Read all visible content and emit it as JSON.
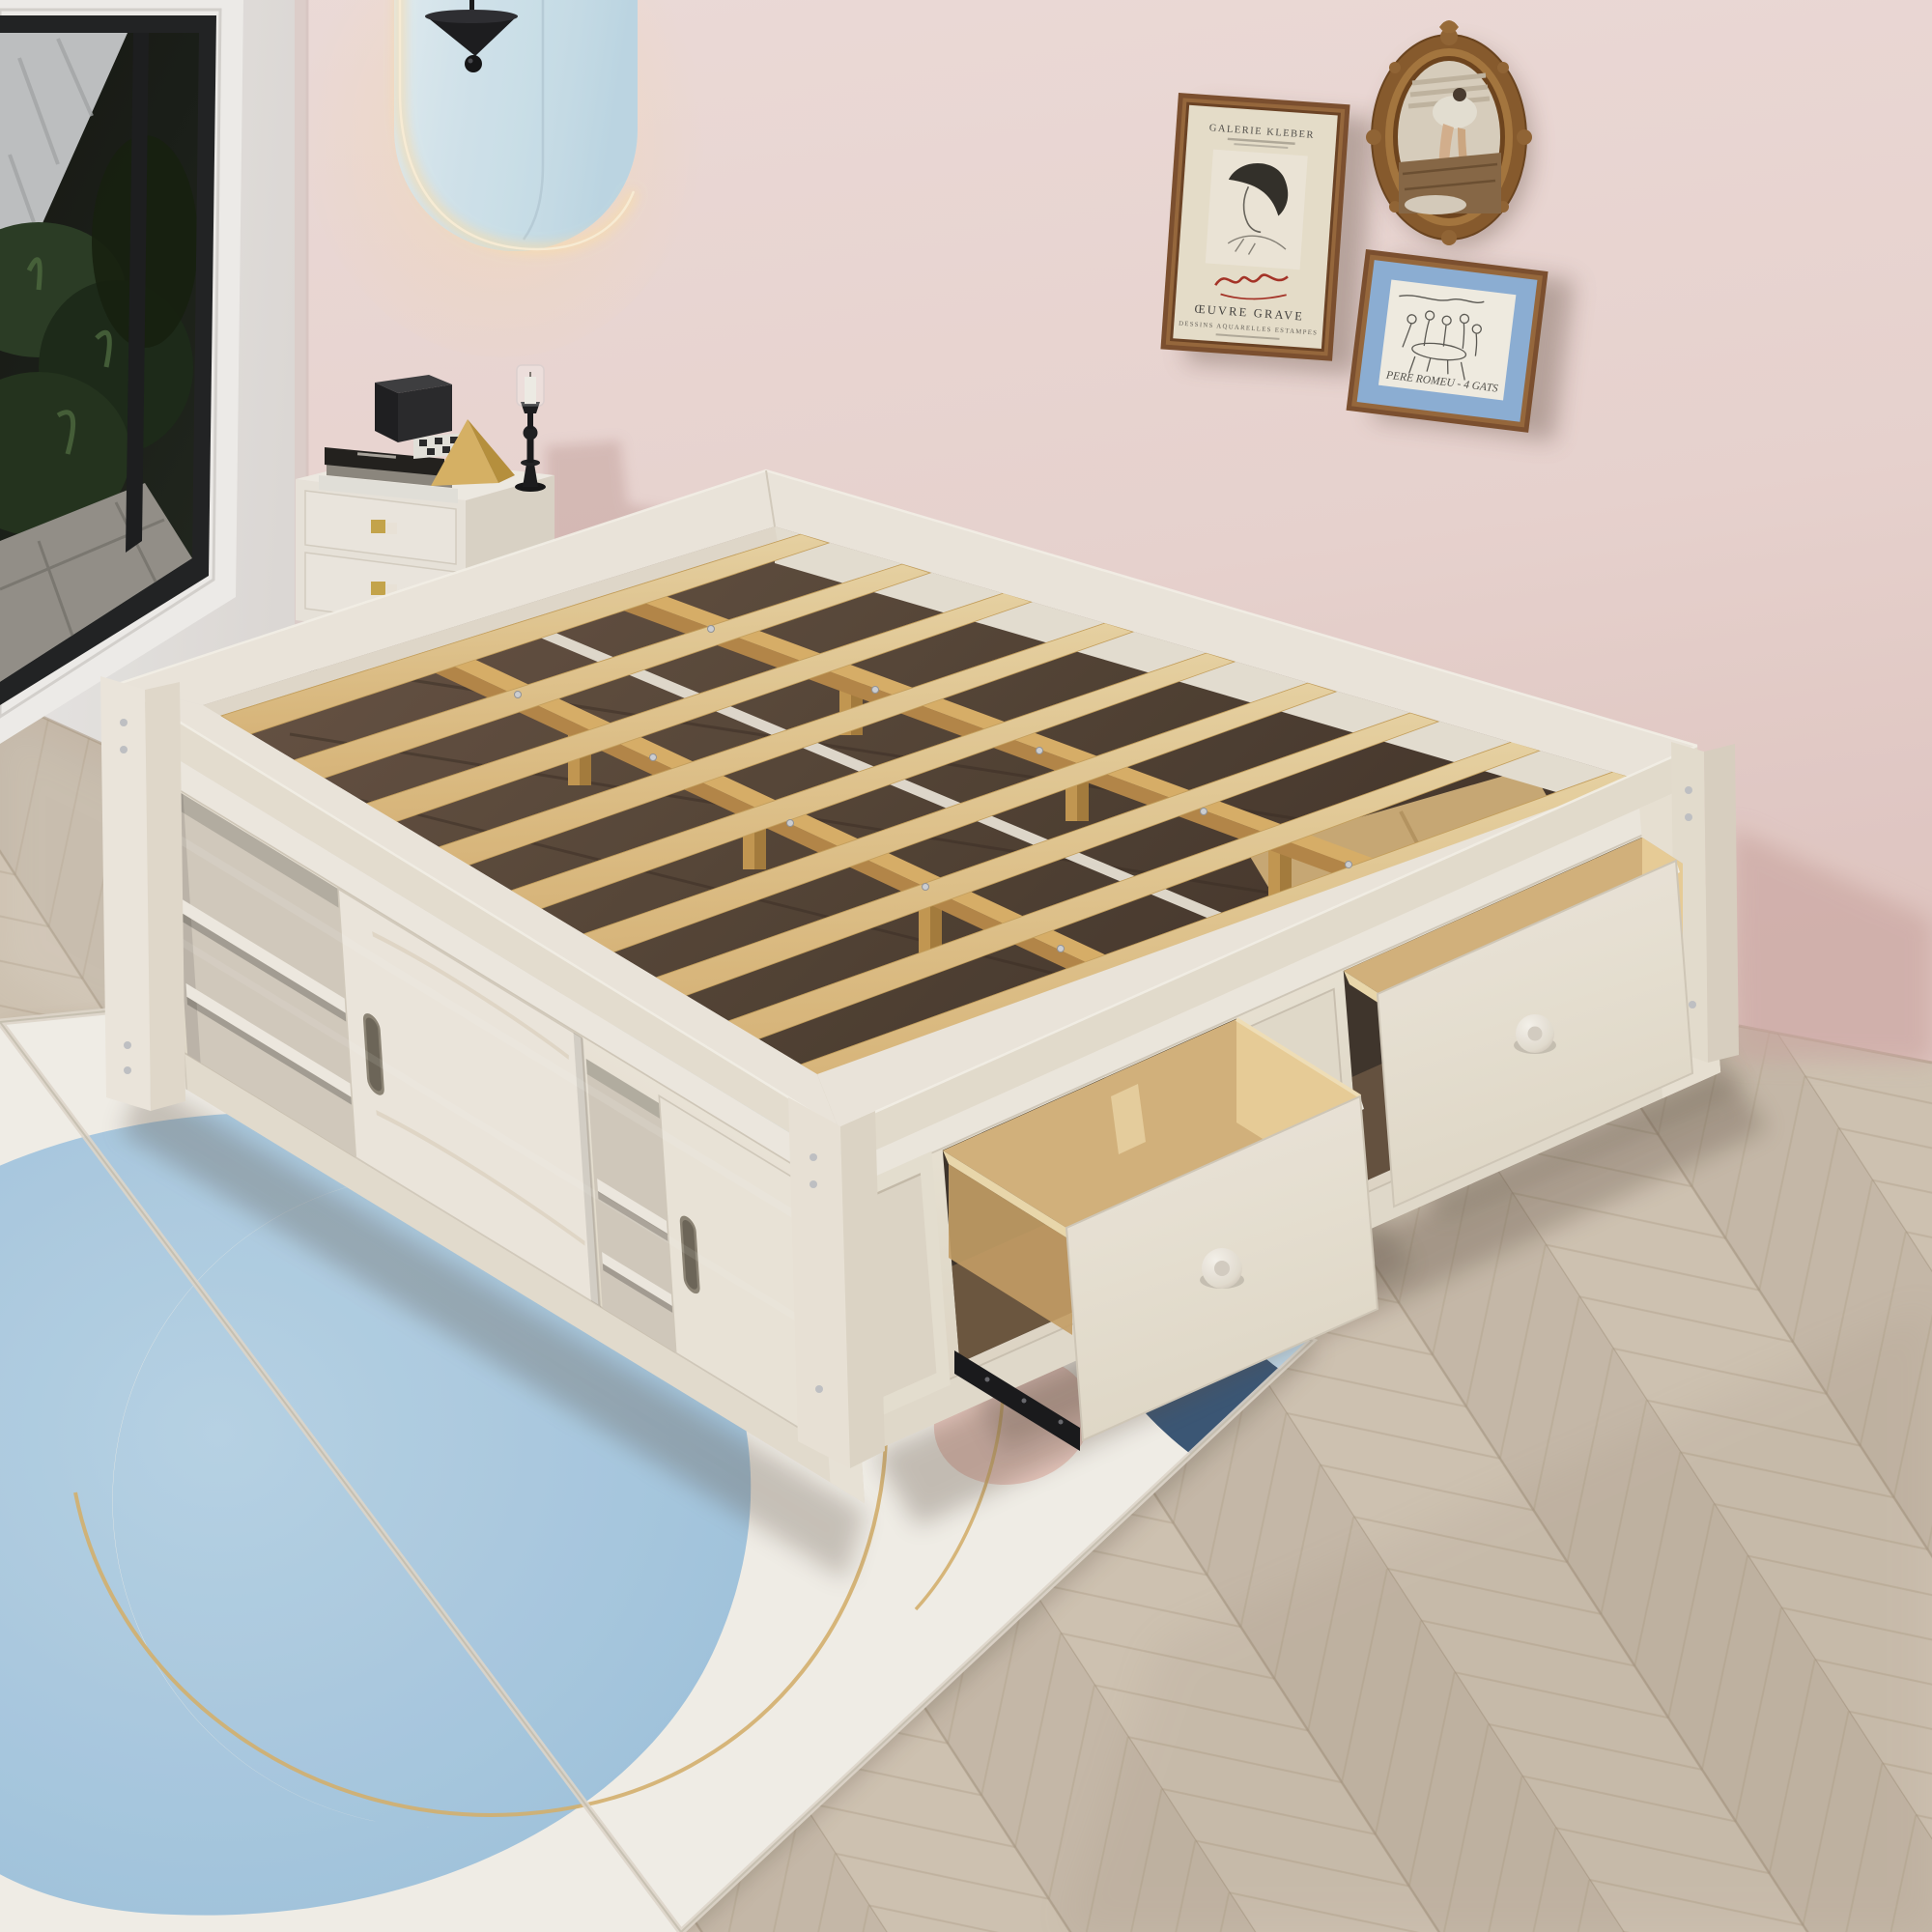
{
  "meta": {
    "scene": "bedroom-product-render",
    "subject": "White-wash platform storage bed with exposed pine slats, sliding-door cubbies and two pull-out side drawers, styled in a pink bedroom"
  },
  "palette": {
    "wall_pink": "#f0dcd9",
    "wall_pink_deep": "#e7cdc9",
    "wall_left": "#ebe8e6",
    "floor": "#d2c5b4",
    "bed_white": "#f1ebe1",
    "bed_white_shade": "#e7dfd1",
    "slat_wood": "#e9cf9e",
    "slat_side": "#c49a56",
    "plywood": "#d8b67f",
    "plywood_bright": "#eed29c",
    "interior": "#574639",
    "rug_base": "#f7f4ee",
    "rug_blue": "#a9cde6",
    "rug_blue_light": "#c3dcee",
    "rug_navy": "#3c5878",
    "rug_pink": "#edccc3",
    "rug_gold": "#d9b570",
    "frame_wood": "#7e5130",
    "mat_blue": "#8fb2da",
    "poster_paper": "#ece3d0",
    "lamp_black": "#1d1d20",
    "knob_gold": "#c9a84c",
    "glow": "#ffe3b4",
    "mirror": "#d6e9f2"
  },
  "artwork": {
    "poster": {
      "gallery": "GALERIE KLEBER",
      "work": "ŒUVRE GRAVE",
      "media": "DESSINS AQUARELLES ESTAMPES",
      "signature": "Vertès"
    },
    "sketch": {
      "caption": "PERE ROMEU - 4 GATS"
    }
  }
}
